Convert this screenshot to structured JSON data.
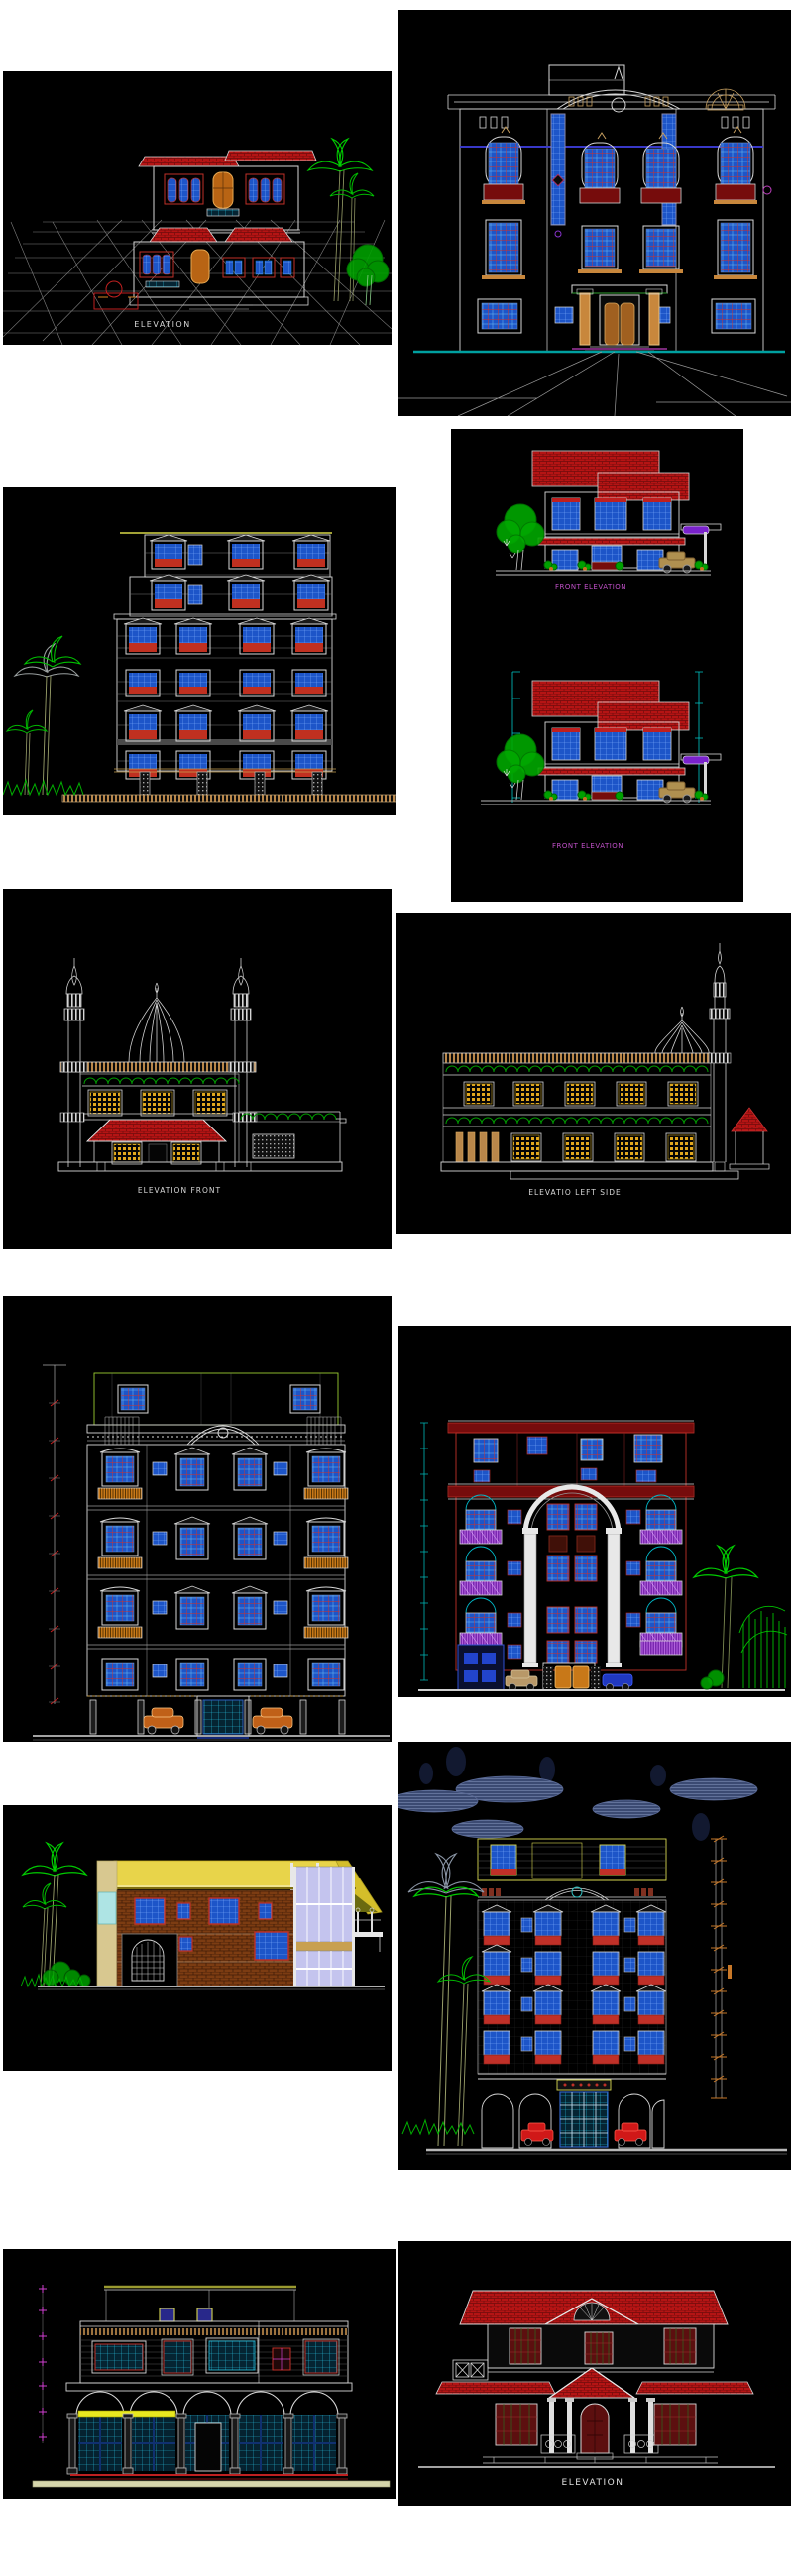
{
  "page": {
    "background_color": "#ffffff",
    "content_type": "grid of 12 CAD elevation drawing images"
  },
  "palette": {
    "cad_background": "#000000",
    "line_white": "#e0e0e0",
    "roof_red": "#bb1515",
    "window_blue": "#1d55c8",
    "grid_cyan": "#28c8e8",
    "tree_green": "#00cc00",
    "wood_tan": "#c8873c",
    "lattice_yellow": "#e2a81e",
    "label_magenta": "#c050c8",
    "dimension_cyan": "#00c8c8",
    "dimension_red": "#c82020",
    "dimension_orange": "#c87828",
    "dimension_magenta": "#d040d0",
    "roof_yellow": "#e8d44a",
    "brick_brown": "#7c3c12",
    "cloud_navy": "#3b4a72",
    "sign_purple": "#7a22cc",
    "ground_teal": "#00a0a0"
  },
  "panels": [
    {
      "name": "villa-perspective-elevation",
      "label": "ELEVATION"
    },
    {
      "name": "palace-front-elevation",
      "label": ""
    },
    {
      "name": "apartment-block-elevation",
      "label": ""
    },
    {
      "name": "two-house-front-elevations",
      "label_top": "FRONT ELEVATION",
      "label_bottom": "FRONT ELEVATION"
    },
    {
      "name": "mosque-front-elevation",
      "label": "ELEVATION FRONT"
    },
    {
      "name": "mosque-left-side-elevation",
      "label": "ELEVATIO LEFT SIDE"
    },
    {
      "name": "ornate-apartment-elevation",
      "label": ""
    },
    {
      "name": "arched-apartment-elevation",
      "label": ""
    },
    {
      "name": "modern-villa-elevation",
      "label": ""
    },
    {
      "name": "night-apartment-elevation",
      "label": ""
    },
    {
      "name": "commercial-arcade-elevation",
      "label": ""
    },
    {
      "name": "classic-house-elevation",
      "label": "ELEVATION"
    }
  ]
}
